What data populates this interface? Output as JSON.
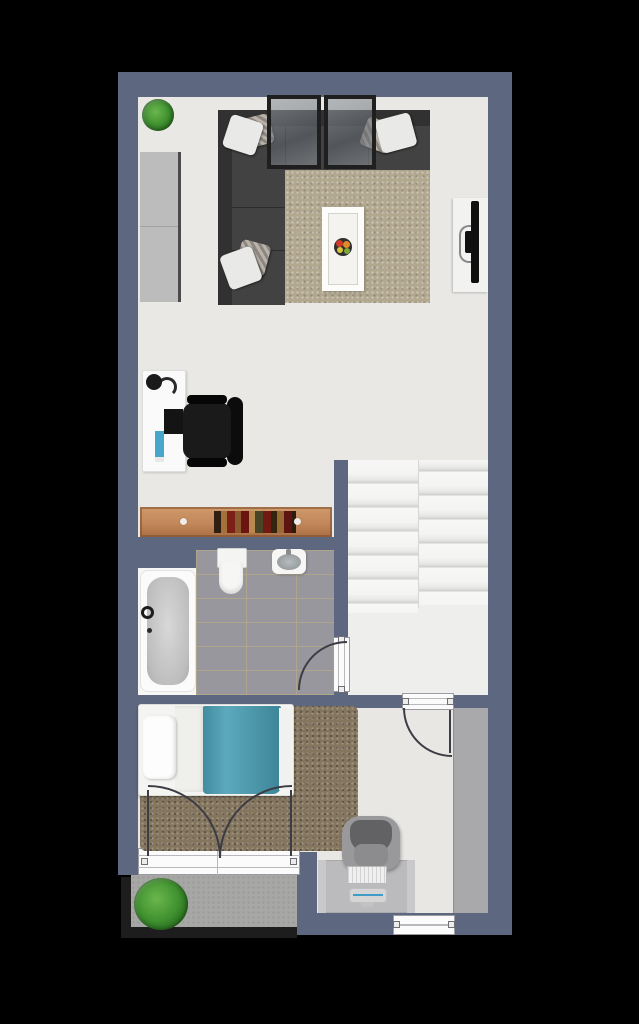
{
  "meta": {
    "title": "apartment-floor-plan",
    "style": "top-down 3D rendered floor plan",
    "background_color": "#000000"
  },
  "palette": {
    "wall": "#5e6780",
    "floor": "#e9e8e5",
    "floor2": "#e8e7e4",
    "tile": "#97979d",
    "grout": "#aea58c",
    "rug1": "#b2a890",
    "rug2": "#84755e",
    "balcony": "#a7a7a5",
    "railing": "#1d1d1d",
    "wood": "#c2875a",
    "blanket": "#4a9fb5",
    "sofa": "#424242",
    "sofa_back": "#313131",
    "dark": "#121212",
    "white": "#f5f5f4",
    "step": "#f6f6f5",
    "step_edge": "#d2d2d2",
    "glass": "#7d828a",
    "plant": "#3c8a2d",
    "desk2": "#bbbbbd",
    "wardrobe": "#a9a9ab",
    "chair2": "#99999b",
    "accent": "#49a5c9"
  },
  "rooms": {
    "living_room": {
      "name": "Living room",
      "furniture": [
        "corner-sofa",
        "throw-pillows",
        "area-rug",
        "coffee-table",
        "fruit-bowl",
        "glass-panels",
        "tall-cabinet",
        "tv-on-board",
        "potted-plant"
      ]
    },
    "workspace": {
      "name": "Workspace",
      "furniture": [
        "white-desk",
        "desk-lamp",
        "monitor",
        "blue-pad",
        "black-office-chair",
        "wooden-sideboard-with-books"
      ]
    },
    "bathroom": {
      "name": "Bathroom",
      "floor": "gray tile",
      "furniture": [
        "bathtub",
        "toilet",
        "washbasin"
      ]
    },
    "staircase": {
      "name": "Staircase",
      "details": [
        "double flight of stairs",
        "landing"
      ]
    },
    "bedroom": {
      "name": "Bedroom",
      "furniture": [
        "single-bed",
        "white-pillow",
        "teal-blanket",
        "brown-shag-rug",
        "wardrobe-strip",
        "french-doors-to-balcony"
      ]
    },
    "office_nook": {
      "name": "Office nook",
      "furniture": [
        "gray-desk",
        "gray-office-chair",
        "keyboard",
        "laptop"
      ]
    },
    "balcony": {
      "name": "Balcony",
      "furniture": [
        "potted-plant",
        "dark-railing"
      ]
    }
  },
  "doors": [
    "bathroom-door",
    "bedroom-door",
    "double-french-doors"
  ],
  "windows": [
    "bedroom-balcony-window",
    "office-nook-window"
  ]
}
